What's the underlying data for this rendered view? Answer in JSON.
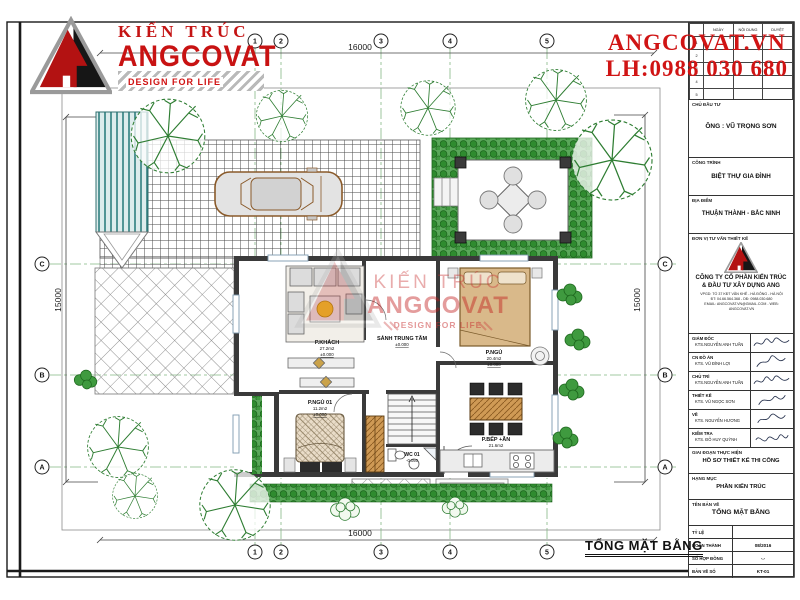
{
  "brand": {
    "kien_truc": "KIẾN TRÚC",
    "name": "ANGCOVAT",
    "tagline": "DESIGN FOR LIFE"
  },
  "contact": {
    "website": "ANGCOVAT.VN",
    "phone": "LH:0988 030 680"
  },
  "drawing": {
    "title": "TỔNG MẶT BẰNG",
    "dims": {
      "top": "16000",
      "bottom": "16000",
      "left": "15000",
      "right": "15000"
    },
    "grid_cols": [
      "1",
      "2",
      "3",
      "4",
      "5"
    ],
    "grid_rows": [
      "C",
      "B",
      "A"
    ],
    "rooms": [
      {
        "name": "P.KHÁCH",
        "area": "27.2m2",
        "elev": "±0.000"
      },
      {
        "name": "SẢNH TRUNG TÂM",
        "area": "",
        "elev": "±0.000"
      },
      {
        "name": "P.NGỦ",
        "area": "20.4m2",
        "elev": "±0.000"
      },
      {
        "name": "P.BẾP +ĂN",
        "area": "21.6m2",
        "elev": "±0.000"
      },
      {
        "name": "P.NGỦ 01",
        "area": "11.2m2",
        "elev": "±0.000"
      },
      {
        "name": "WC 01",
        "area": "",
        "elev": "-0.050"
      }
    ]
  },
  "watermark": {
    "l1": "KIẾN TRÚC",
    "l2": "ANGCOVAT",
    "l3": "DESIGN FOR LIFE"
  },
  "titleblock": {
    "rev_header": [
      "NGÀY",
      "NỘI DUNG",
      "DUYỆT"
    ],
    "rev_rows": [
      "1",
      "2",
      "3",
      "4",
      "5"
    ],
    "sections": {
      "investor_label": "CHỦ ĐẦU TƯ",
      "investor": "ÔNG : VŨ TRỌNG SƠN",
      "project_label": "CÔNG TRÌNH",
      "project": "BIỆT THỰ GIA ĐÌNH",
      "location_label": "ĐỊA ĐIỂM",
      "location": "THUẬN THÀNH - BẮC NINH",
      "consultant_label": "ĐƠN VỊ TƯ VẤN THIẾT KẾ",
      "company_line1": "CÔNG TY CỔ PHẦN KIẾN TRÚC",
      "company_line2": "& ĐẦU TƯ XÂY DỰNG ANG",
      "address1": "VPGD: TỔ 37 KĐT VĂN KHÊ - HÀ ĐÔNG - HÀ NỘI",
      "address2": "ĐT: 04.66.564.368 - DĐ: 0988.030.680",
      "address3": "EMAIL: ANGCOVAT.VN@GMAIL.COM - WEB: ANGCOVAT.VN",
      "stage_label": "GIAI ĐOẠN THỰC HIỆN",
      "stage": "HỒ SƠ THIẾT KẾ THI CÔNG",
      "category_label": "HẠNG MỤC",
      "category": "PHẦN KIẾN TRÚC",
      "sheet_label": "TÊN BẢN VẼ",
      "sheet": "TỔNG MẶT BẰNG"
    },
    "signers": [
      {
        "role": "GIÁM ĐỐC",
        "name": "KTS.NGUYỄN ANH TUẤN"
      },
      {
        "role": "CN ĐỒ ÁN",
        "name": "KTS. VŨ ĐÌNH LỢI"
      },
      {
        "role": "CHỦ TRÌ",
        "name": "KTS.NGUYỄN ANH TUẤN"
      },
      {
        "role": "THIẾT KẾ",
        "name": "KTS. VŨ NGỌC SƠN"
      },
      {
        "role": "VẼ",
        "name": "KTS. NGUYỄN HƯƠNG"
      },
      {
        "role": "KIỂM TRA",
        "name": "KTS. ĐỖ HUY QUỲNH"
      }
    ],
    "footer": [
      {
        "label": "TỶ LỆ",
        "value": ""
      },
      {
        "label": "HOÀN THÀNH",
        "value": "08/2016"
      },
      {
        "label": "SỐ HỢP ĐỒNG",
        "value": "-.-"
      },
      {
        "label": "BẢN VẼ SỐ",
        "value": "KT-01"
      }
    ]
  }
}
